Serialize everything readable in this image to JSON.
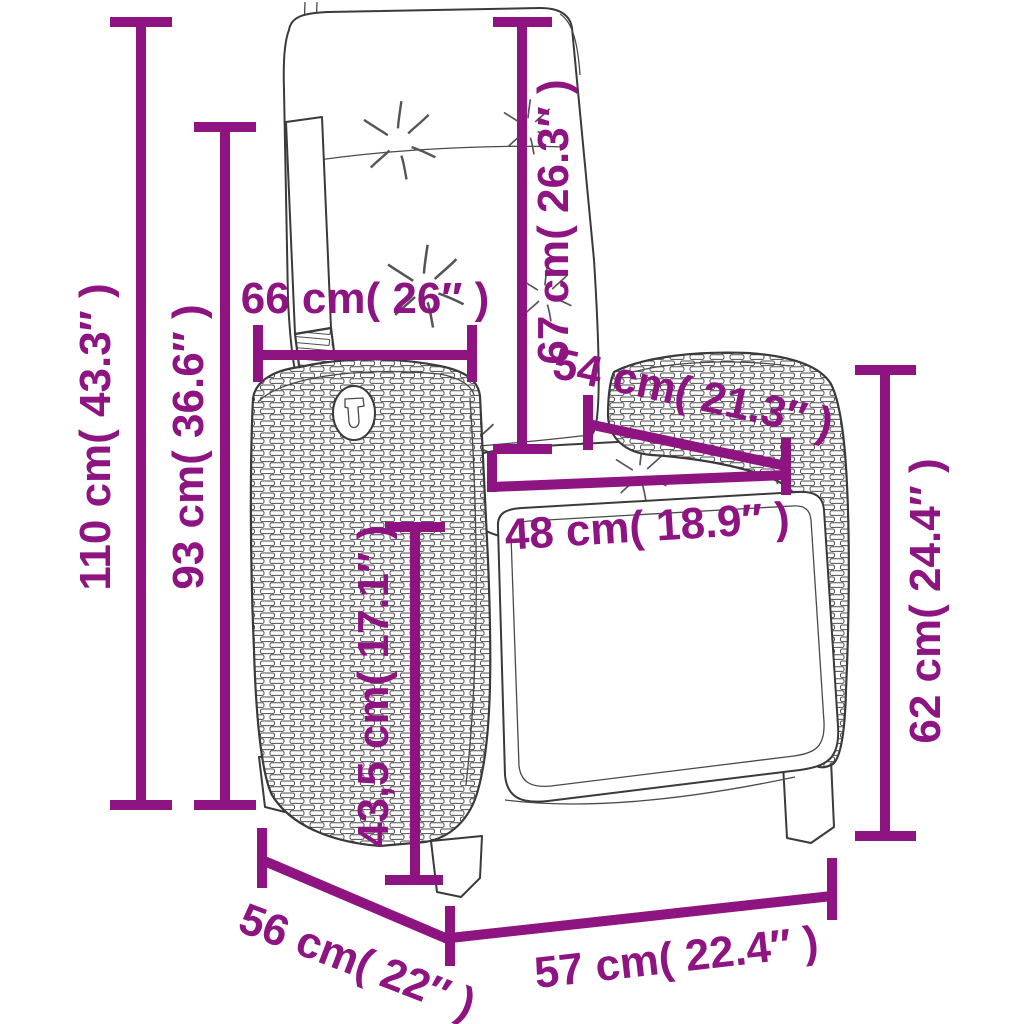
{
  "page": {
    "title": "Reclining garden chair — dimension diagram",
    "background": "#ffffff"
  },
  "colors": {
    "dimension_accent": "#8e1482",
    "drawing_outline": "#3a3a3a"
  },
  "figure": {
    "subject": "reclining poly-rattan garden chair with back cushion",
    "style": "black-and-white line drawing with woven rattan texture and purple dimension lines"
  },
  "dimensions": [
    {
      "id": "total-height",
      "label": "110 cm( 43.3″ )",
      "cm": "110",
      "inches": "43.3",
      "orientation": "vertical"
    },
    {
      "id": "back-height",
      "label": "93 cm( 36.6″ )",
      "cm": "93",
      "inches": "36.6",
      "orientation": "vertical"
    },
    {
      "id": "back-width",
      "label": "66 cm( 26″ )",
      "cm": "66",
      "inches": "26",
      "orientation": "horizontal"
    },
    {
      "id": "backrest-length",
      "label": "67 cm( 26.3″ )",
      "cm": "67",
      "inches": "26.3",
      "orientation": "vertical"
    },
    {
      "id": "armrest-depth",
      "label": "54 cm( 21.3″ )",
      "cm": "54",
      "inches": "21.3",
      "orientation": "diagonal"
    },
    {
      "id": "seat-width",
      "label": "48 cm( 18.9″ )",
      "cm": "48",
      "inches": "18.9",
      "orientation": "horizontal"
    },
    {
      "id": "seat-height",
      "label": "43,5 cm( 17.1″ )",
      "cm": "43,5",
      "inches": "17.1",
      "orientation": "vertical"
    },
    {
      "id": "armrest-height",
      "label": "62 cm( 24.4″ )",
      "cm": "62",
      "inches": "24.4",
      "orientation": "vertical"
    },
    {
      "id": "seat-depth",
      "label": "56 cm( 22″ )",
      "cm": "56",
      "inches": "22",
      "orientation": "diagonal"
    },
    {
      "id": "front-width",
      "label": "57 cm( 22.4″ )",
      "cm": "57",
      "inches": "22.4",
      "orientation": "horizontal"
    }
  ]
}
